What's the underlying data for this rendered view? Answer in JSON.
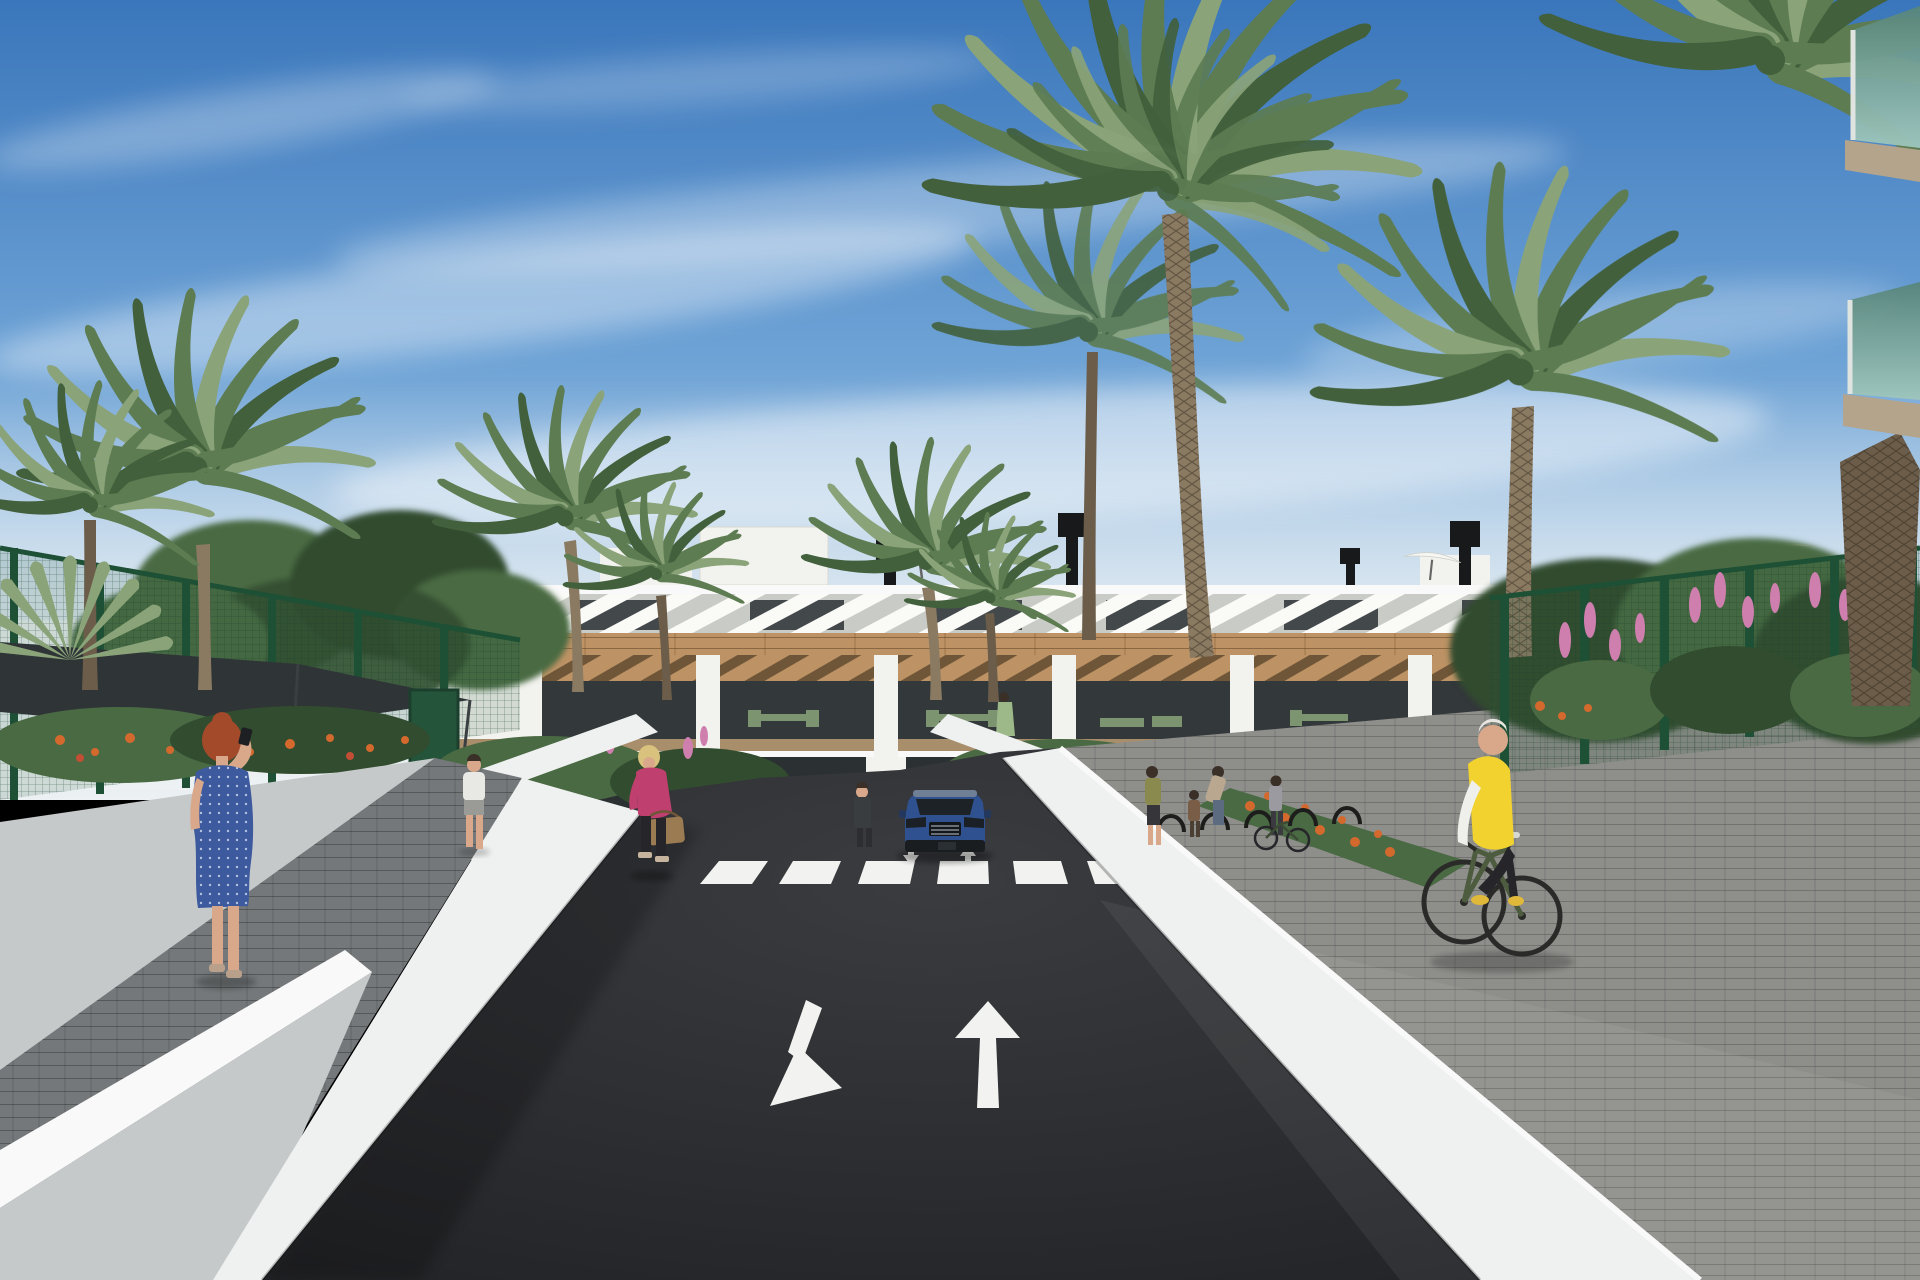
{
  "image": {
    "type": "3d-architectural-rendering",
    "width": 1920,
    "height": 1280,
    "description": "Sunny street-level visualization of a modern white Mediterranean apartment complex with timber cladding and slatted sun screens. A dark asphalt access road with a white zebra crosswalk and painted direction arrows leads to the building; palm trees, green sports-court fencing, flower beds, pedestrians and an elderly cyclist fill the scene."
  },
  "sky": {
    "condition": "clear blue with wispy cirrus cloud streaks and pale haze at the horizon"
  },
  "building": {
    "floors": 3,
    "style": "white render with timber band, balcony pergolas and diagonal white roof slats",
    "features": [
      "roof terraces",
      "white parasols",
      "black chimney vents",
      "timber pergola balconies",
      "floor-to-ceiling glazing",
      "green outdoor furniture"
    ],
    "right_edge_foreground": "two balcony slabs with green-tinted glass balustrades and beige soffits"
  },
  "road": {
    "surface": "dark asphalt",
    "markings": {
      "crosswalk_stripes": 8,
      "large_lane_arrows": [
        "down-left",
        "straight-up"
      ],
      "small_arrows_at_crosswalk": [
        "down",
        "up"
      ]
    },
    "garage": "dark parking entrance below the building with small wall plaque"
  },
  "vehicles": [
    {
      "id": "blue-suv",
      "type": "SUV",
      "color": "#30518f",
      "position": "facing viewer at garage entrance"
    }
  ],
  "people": [
    {
      "id": "woman-on-phone",
      "hair": "red updo",
      "clothes": "blue knee-length dress with white dots",
      "action": "standing on left path talking on phone"
    },
    {
      "id": "man-white-tshirt",
      "clothes": "white t-shirt, grey shorts",
      "action": "walking away near green gate"
    },
    {
      "id": "woman-pink-jacket",
      "hair": "blonde",
      "clothes": "magenta jacket, black trousers, brown handbag",
      "action": "walking toward viewer on left path"
    },
    {
      "id": "person-at-entrance",
      "clothes": "dark overalls",
      "action": "standing on walkway left of car"
    },
    {
      "id": "woman-green-dress-balcony",
      "action": "standing on first-floor balcony"
    },
    {
      "id": "resident-right-balcony",
      "clothes": "blue shirt",
      "action": "standing on far right-wing balcony"
    },
    {
      "id": "group-near-bike-racks",
      "members": [
        "woman olive top",
        "child",
        "woman bending",
        "woman with bicycle"
      ],
      "action": "gathered by bicycle racks"
    },
    {
      "id": "elderly-cyclist",
      "hair": "white",
      "clothes": "yellow vest over white sleeves, black trousers, yellow shoes",
      "action": "cycling toward viewer on right paved path"
    }
  ],
  "landscaping": {
    "palms": [
      "tall left palm pair",
      "fan palm far left",
      "planter palms by entrance",
      "huge central date palm",
      "tall right palm",
      "right-edge thick palm trunk"
    ],
    "fences": [
      "green mesh sports-court fence left with dark shade sail",
      "green mesh fence right"
    ],
    "flowers": [
      "orange marigold beds",
      "pink flower spikes along right fence",
      "pink blossoms near left path"
    ]
  },
  "colors": {
    "sky_top": "#3a76bb",
    "sky_mid": "#6ea3d6",
    "sky_low": "#b9d2e6",
    "haze": "#edf1f3",
    "cloud": "#ffffff",
    "building_white": "#f2f2ee",
    "building_shade": "#e2e2da",
    "slat_window": "#43484b",
    "timber": "#bd9365",
    "timber_dark": "#97714a",
    "glass_dark": "#33383a",
    "ground_glass": "#2b3032",
    "rail_wood": "#a98e6b",
    "furniture_green": "#7d9471",
    "fence_green": "#2a5f41",
    "fence_post": "#1d5034",
    "sail_dark": "#2f3437",
    "foliage_dark": "#324c2f",
    "foliage_mid": "#4a6a43",
    "foliage_light": "#6d8a5e",
    "palm_green": "#5d7c52",
    "palm_dark": "#42603c",
    "palm_light": "#8aa379",
    "trunk": "#8a7a62",
    "trunk_dark": "#6b5d49",
    "flower_orange": "#d4692e",
    "flower_red": "#c24e35",
    "flower_pink": "#cf7fae",
    "asphalt": "#222326",
    "marking_white": "#f2f3f0",
    "wall_white": "#eff1f1",
    "wall_bright": "#f8f9f8",
    "wall_gray": "#c5c9ca",
    "paver_dark": "#74787a",
    "brick_gray": "#8e8e8b",
    "walkway_tan": "#b5b2a6",
    "garage_dark": "#15171a",
    "car_blue": "#30518f",
    "car_glass": "#1c2226",
    "car_gray": "#6f7f96",
    "skin": "#d9a88a",
    "hair_red": "#a34a2a",
    "hair_blonde": "#d9c27e",
    "hair_white": "#e8e6e0",
    "hair_dark": "#3a3028",
    "dress_blue": "#3d5a9e",
    "dress_dot": "#c8d4ea",
    "jacket_pink": "#bf3f6e",
    "pants_black": "#26262a",
    "bag_brown": "#9a7b52",
    "tee_white": "#e8e8e4",
    "vest_yellow": "#f2d22e",
    "sleeve_white": "#efefec",
    "shoe_yellow": "#e0b83a",
    "bike_green": "#4d5c3e",
    "glass_teal_a": "#57857a",
    "glass_teal_b": "#9fc6bc",
    "tan_soffit": "#b3a48b",
    "sign_dark": "#2b2e30"
  }
}
